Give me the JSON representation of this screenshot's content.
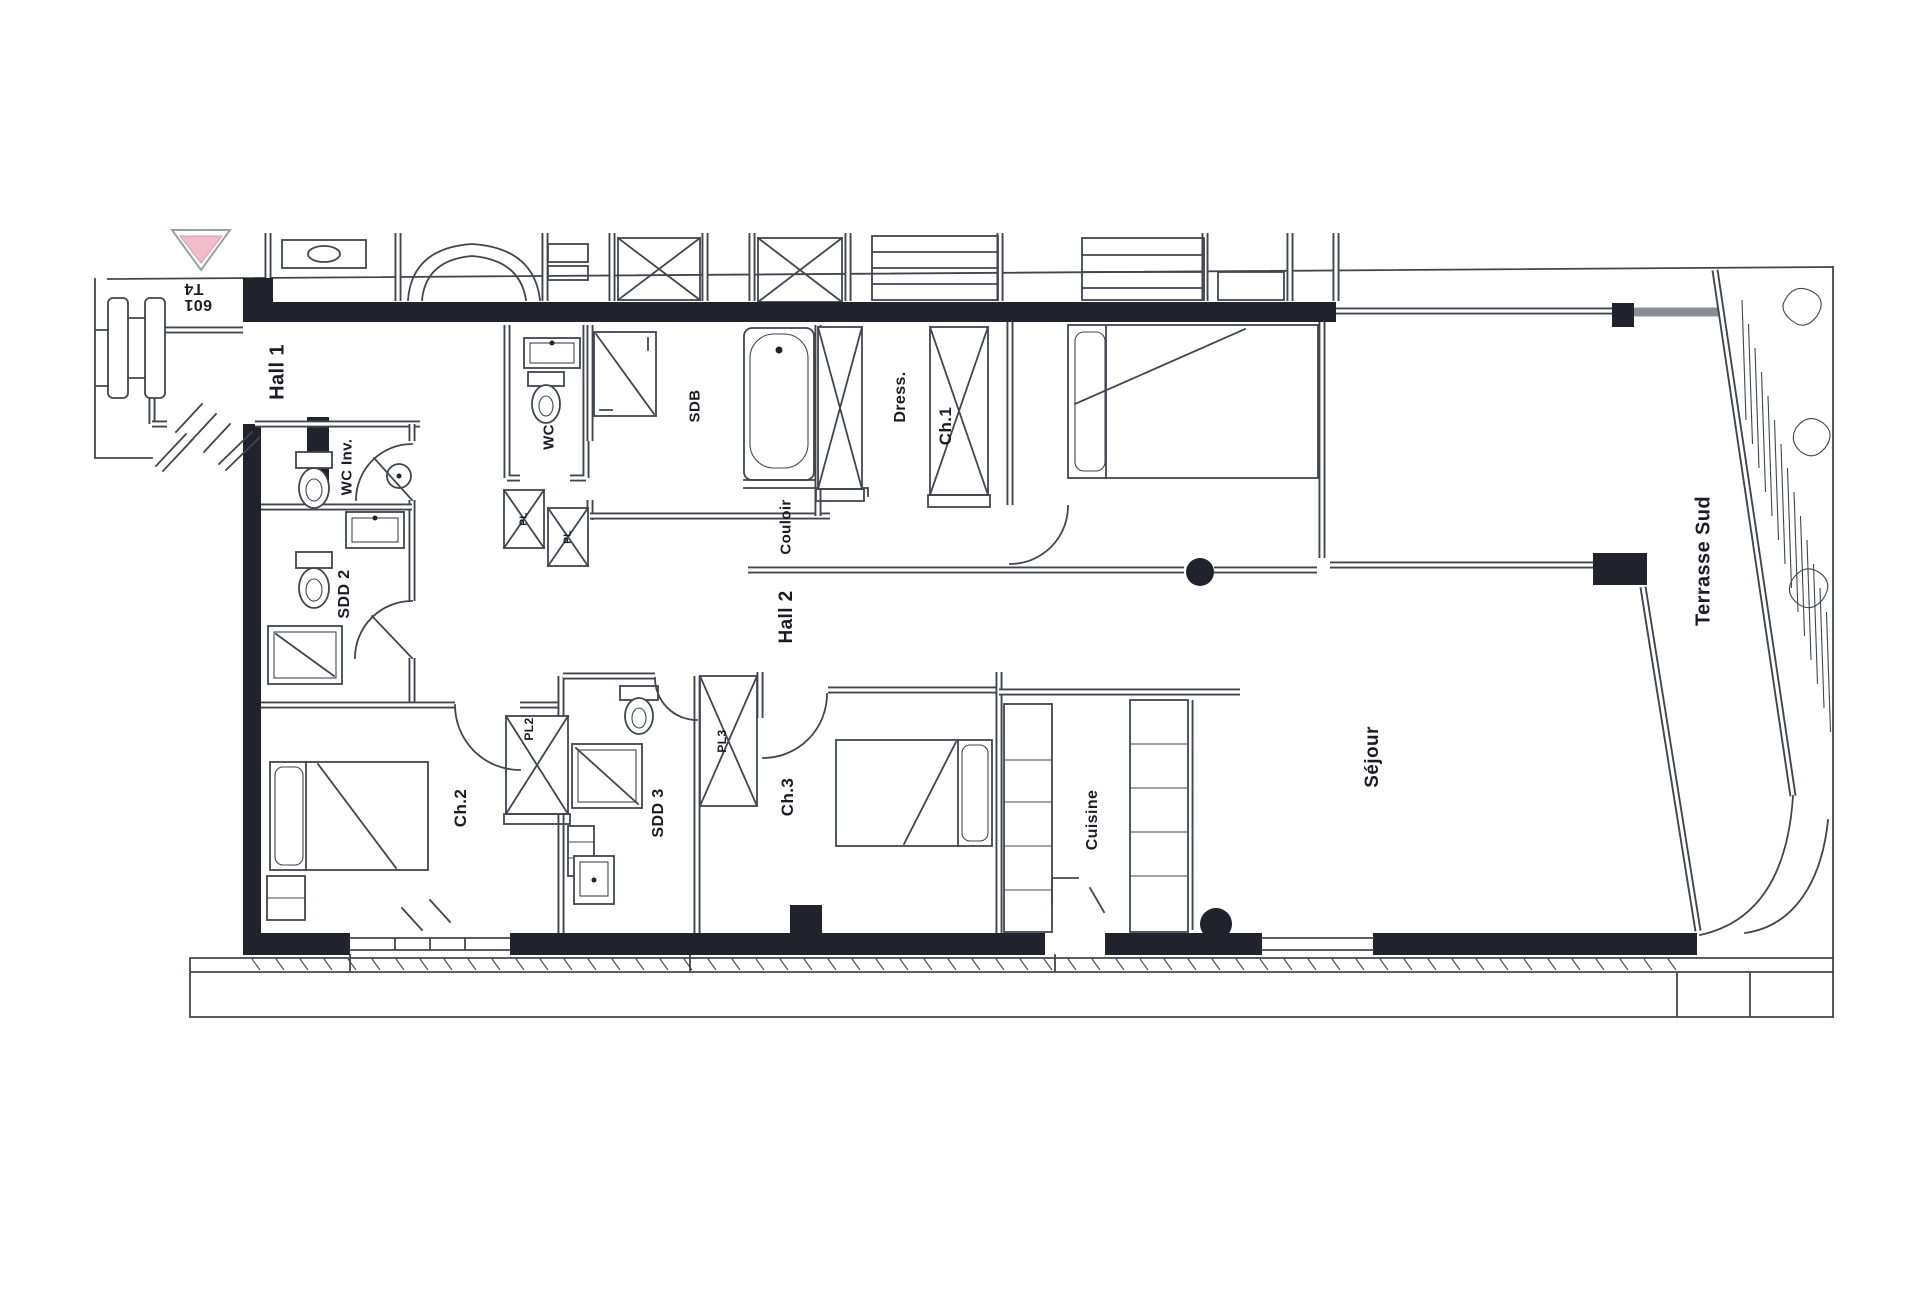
{
  "marker": {
    "unit": "601",
    "type": "T4"
  },
  "labels": {
    "hall1": "Hall 1",
    "wc_inv": "WC Inv.",
    "sdd2": "SDD 2",
    "wc": "WC",
    "pl_left": "PL",
    "pl_right": "PL",
    "sdb": "SDB",
    "couloir": "Couloir",
    "hall2": "Hall 2",
    "dress": "Dress.",
    "ch1": "Ch.1",
    "ch2": "Ch.2",
    "pl2": "PL2",
    "sdd3": "SDD 3",
    "pl3": "PL3",
    "ch3": "Ch.3",
    "cuisine": "Cuisine",
    "sejour": "Séjour",
    "terrasse_sud": "Terrasse Sud"
  },
  "colors": {
    "wall": "#20222c",
    "line": "#42454e",
    "gray_band": "#8b8d94",
    "marker_pink": "#f1bccb",
    "text": "#1b1b26"
  }
}
